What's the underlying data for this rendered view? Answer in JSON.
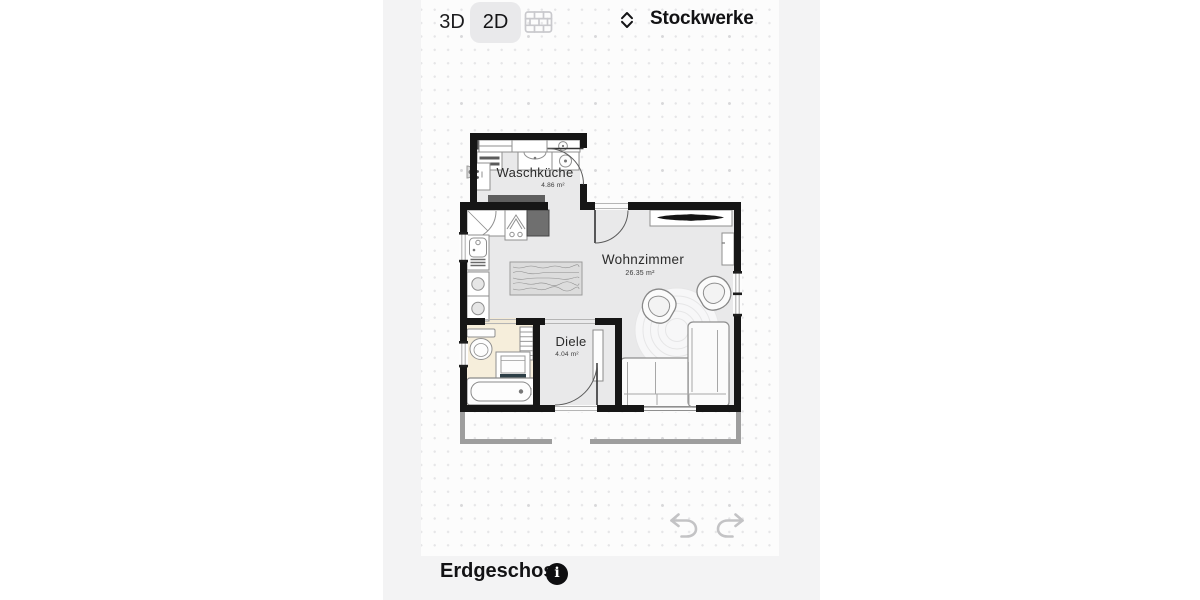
{
  "header": {
    "btn_3d": "3D",
    "btn_2d": "2D",
    "floor_selector_label": "Stockwerke"
  },
  "floorplan": {
    "rooms": [
      {
        "name": "Waschküche",
        "area": "4.86 m²"
      },
      {
        "name": "Wohnzimmer",
        "area": "26.35 m²"
      },
      {
        "name": "Diele",
        "area": "4.04 m²"
      }
    ]
  },
  "footer": {
    "floor_name": "Erdgeschoss",
    "info_glyph": "i"
  },
  "icons": {
    "wall_mode": "brick-wall-icon",
    "floor_selector": "up-down-chevrons-icon",
    "undo": "undo-arrow-icon",
    "redo": "redo-arrow-icon",
    "info": "info-icon"
  },
  "colors": {
    "active_toggle_bg": "#e9e9eb",
    "wall": "#161616",
    "floor": "#e9e9ea",
    "bathroom_floor": "#f6eedb",
    "accent_teal": "#49a3ad",
    "disabled_icon": "#c9c9cd",
    "ghost_wall": "#9e9e9e"
  }
}
